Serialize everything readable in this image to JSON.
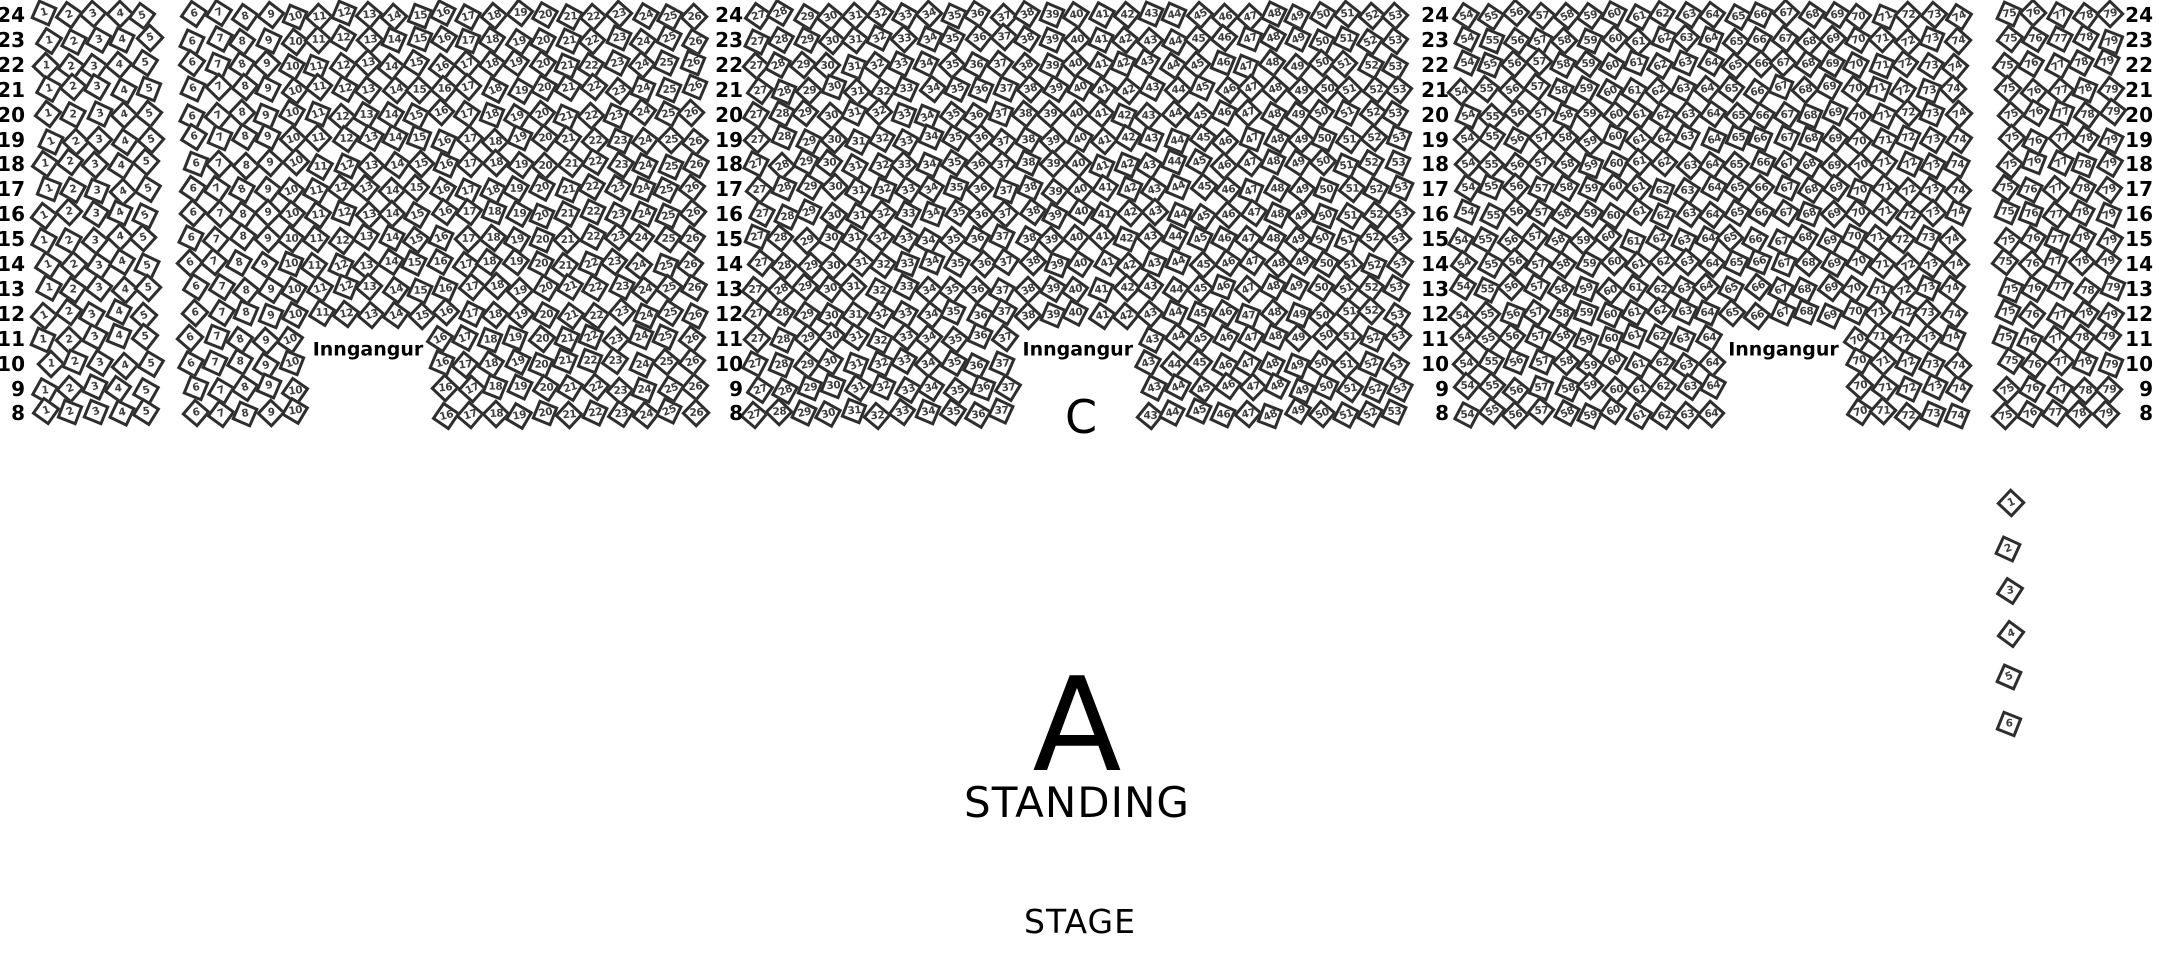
{
  "map_title": "",
  "rows_top_to_bottom": [
    24,
    23,
    22,
    21,
    20,
    19,
    18,
    17,
    16,
    15,
    14,
    13,
    12,
    11,
    10,
    9,
    8
  ],
  "entrance_label": "Inngangur",
  "section_labels": {
    "c": "C",
    "standing_letter": "A",
    "standing_text": "STANDING",
    "stage": "STAGE"
  },
  "seat_blocks": [
    {
      "name": "block-1-5",
      "first_seat": 1,
      "last_seat": 5,
      "entrance_gap": null
    },
    {
      "name": "block-6-26",
      "first_seat": 6,
      "last_seat": 26,
      "entrance_gap": {
        "rows": [
          11,
          10,
          9,
          8
        ],
        "first_missing": 11,
        "last_missing": 15
      }
    },
    {
      "name": "block-27-53",
      "first_seat": 27,
      "last_seat": 53,
      "entrance_gap": {
        "rows": [
          11,
          10,
          9,
          8
        ],
        "first_missing": 38,
        "last_missing": 42
      }
    },
    {
      "name": "block-54-74",
      "first_seat": 54,
      "last_seat": 74,
      "entrance_gap": {
        "rows": [
          11,
          10,
          9,
          8
        ],
        "first_missing": 65,
        "last_missing": 69
      }
    },
    {
      "name": "block-75-79",
      "first_seat": 75,
      "last_seat": 79,
      "entrance_gap": null
    }
  ],
  "row_label_columns": 4,
  "side_seats": [
    "1",
    "2",
    "3",
    "4",
    "5",
    "6"
  ],
  "colors": {
    "bg": "#ffffff",
    "seat_fill": "#ffffff",
    "seat_border": "#2e2e2e",
    "seat_number": "#3d3d3d",
    "text": "#000000"
  }
}
